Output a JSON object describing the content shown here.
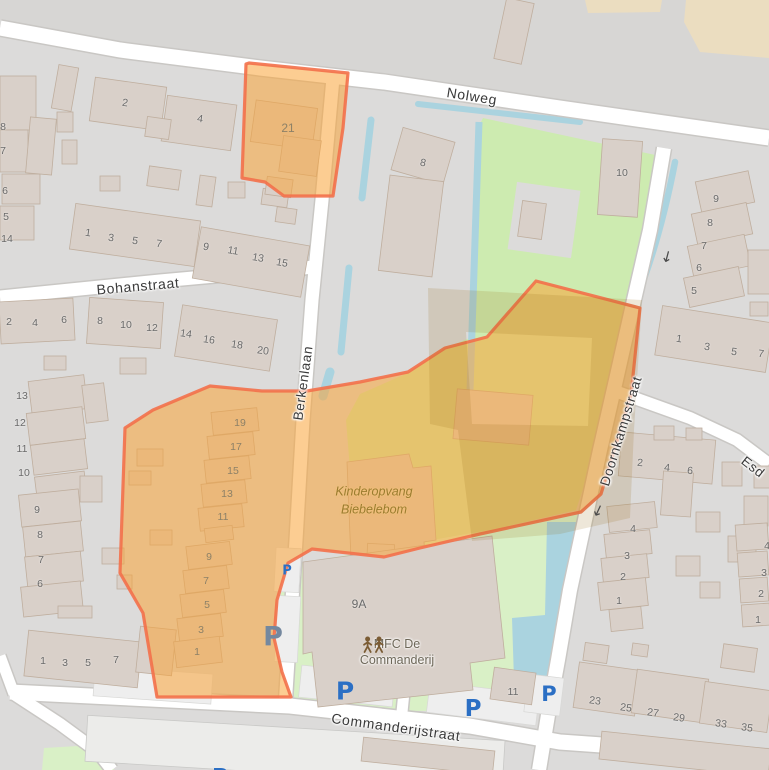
{
  "meta": {
    "width": 769,
    "height": 770,
    "kind": "openstreetmap-view"
  },
  "colors": {
    "bg": "#dcdbda",
    "bg_top": "#d7d6d4",
    "road": "#ffffff",
    "road_casing": "#c9c7c4",
    "building": "#d9d0c9",
    "building_stroke": "#bfae9e",
    "industrial": "#ececea",
    "green": "#cdebb0",
    "green_light": "#d9f0c6",
    "water": "#aad3df",
    "farmland": "#ebddc0",
    "parking_lot": "#eeeeee",
    "sel_fill": "rgba(250,164,56,0.55)",
    "sel_stroke": "#f3704a",
    "shade": "rgba(150,105,20,0.16)",
    "street_text": "#3a3a3a",
    "housenumber": "#6a6a6a",
    "housenumber_dim": "#8d8167",
    "parking_blue": "#2b6fc4",
    "parking_dim": "#74889f",
    "arrow": "#4a4a4a",
    "poi_kdv": "#9a7c2e",
    "poi_mfc": "#6d6758",
    "poi_icon": "#7b5c34"
  },
  "streets": [
    {
      "text": "Nolweg",
      "x": 472,
      "y": 96,
      "rot": 9,
      "size": 14
    },
    {
      "text": "Bohanstraat",
      "x": 138,
      "y": 286,
      "rot": -5,
      "size": 14
    },
    {
      "text": "Berkenlaan",
      "x": 303,
      "y": 383,
      "rot": -82,
      "size": 13.5
    },
    {
      "text": "Doornkampstraat",
      "x": 621,
      "y": 431,
      "rot": -73,
      "size": 13.5
    },
    {
      "text": "Commanderijstraat",
      "x": 396,
      "y": 727,
      "rot": 8,
      "size": 14
    },
    {
      "text": "Esd",
      "x": 753,
      "y": 467,
      "rot": 38,
      "size": 13.5
    }
  ],
  "pois": {
    "kinderopvang": {
      "line1": "Kinderopvang",
      "line2": "Biebelebom",
      "x": 374,
      "y": 501
    },
    "mfc": {
      "line1": "MFC De",
      "line2": "Commanderij",
      "x": 397,
      "y": 652,
      "icon": "community-centre-icon"
    }
  },
  "parking_label": "P",
  "oneway_glyph": "↓",
  "house_numbers": [
    {
      "t": "2",
      "x": 125,
      "y": 103,
      "r": 8
    },
    {
      "t": "4",
      "x": 200,
      "y": 119,
      "r": 8
    },
    {
      "t": "8",
      "x": 3,
      "y": 127
    },
    {
      "t": "7",
      "x": 3,
      "y": 151
    },
    {
      "t": "6",
      "x": 5,
      "y": 191
    },
    {
      "t": "5",
      "x": 6,
      "y": 217
    },
    {
      "t": "14",
      "x": 7,
      "y": 239
    },
    {
      "t": "1",
      "x": 88,
      "y": 233,
      "r": 8
    },
    {
      "t": "3",
      "x": 111,
      "y": 238,
      "r": 8
    },
    {
      "t": "5",
      "x": 135,
      "y": 241,
      "r": 8
    },
    {
      "t": "7",
      "x": 159,
      "y": 244,
      "r": 8
    },
    {
      "t": "9",
      "x": 206,
      "y": 247,
      "r": 10
    },
    {
      "t": "11",
      "x": 233,
      "y": 251,
      "r": 10
    },
    {
      "t": "13",
      "x": 258,
      "y": 258,
      "r": 10
    },
    {
      "t": "15",
      "x": 282,
      "y": 263,
      "r": 10
    },
    {
      "t": "2",
      "x": 9,
      "y": 322
    },
    {
      "t": "4",
      "x": 35,
      "y": 323
    },
    {
      "t": "6",
      "x": 64,
      "y": 320
    },
    {
      "t": "8",
      "x": 100,
      "y": 321
    },
    {
      "t": "10",
      "x": 126,
      "y": 325
    },
    {
      "t": "12",
      "x": 152,
      "y": 328
    },
    {
      "t": "14",
      "x": 186,
      "y": 334,
      "r": 8
    },
    {
      "t": "16",
      "x": 209,
      "y": 340,
      "r": 8
    },
    {
      "t": "18",
      "x": 237,
      "y": 345,
      "r": 8
    },
    {
      "t": "20",
      "x": 263,
      "y": 351,
      "r": 8
    },
    {
      "t": "13",
      "x": 22,
      "y": 396
    },
    {
      "t": "12",
      "x": 20,
      "y": 423
    },
    {
      "t": "11",
      "x": 22,
      "y": 449
    },
    {
      "t": "10",
      "x": 24,
      "y": 473
    },
    {
      "t": "9",
      "x": 37,
      "y": 510
    },
    {
      "t": "8",
      "x": 40,
      "y": 535
    },
    {
      "t": "7",
      "x": 41,
      "y": 560
    },
    {
      "t": "6",
      "x": 40,
      "y": 584
    },
    {
      "t": "1",
      "x": 43,
      "y": 661
    },
    {
      "t": "3",
      "x": 65,
      "y": 663
    },
    {
      "t": "5",
      "x": 88,
      "y": 663
    },
    {
      "t": "7",
      "x": 116,
      "y": 660
    },
    {
      "t": "19",
      "x": 240,
      "y": 423,
      "d": 1
    },
    {
      "t": "17",
      "x": 236,
      "y": 447,
      "d": 1
    },
    {
      "t": "15",
      "x": 233,
      "y": 471,
      "d": 1
    },
    {
      "t": "13",
      "x": 227,
      "y": 494,
      "d": 1
    },
    {
      "t": "11",
      "x": 223,
      "y": 517,
      "d": 1
    },
    {
      "t": "9",
      "x": 209,
      "y": 557,
      "d": 1
    },
    {
      "t": "7",
      "x": 206,
      "y": 581,
      "d": 1
    },
    {
      "t": "5",
      "x": 207,
      "y": 605,
      "d": 1
    },
    {
      "t": "3",
      "x": 201,
      "y": 630,
      "d": 1
    },
    {
      "t": "1",
      "x": 197,
      "y": 652,
      "d": 1
    },
    {
      "t": "21",
      "x": 288,
      "y": 128,
      "d": 1,
      "s": 12
    },
    {
      "t": "8",
      "x": 423,
      "y": 163,
      "r": 12
    },
    {
      "t": "10",
      "x": 622,
      "y": 173
    },
    {
      "t": "9",
      "x": 716,
      "y": 199
    },
    {
      "t": "8",
      "x": 710,
      "y": 223
    },
    {
      "t": "7",
      "x": 704,
      "y": 246
    },
    {
      "t": "6",
      "x": 699,
      "y": 268
    },
    {
      "t": "5",
      "x": 694,
      "y": 291
    },
    {
      "t": "1",
      "x": 679,
      "y": 339,
      "r": 8
    },
    {
      "t": "3",
      "x": 707,
      "y": 347,
      "r": 8
    },
    {
      "t": "5",
      "x": 734,
      "y": 352,
      "r": 8
    },
    {
      "t": "7",
      "x": 761,
      "y": 354,
      "r": 8
    },
    {
      "t": "2",
      "x": 640,
      "y": 463,
      "r": 5
    },
    {
      "t": "4",
      "x": 667,
      "y": 468,
      "r": 5
    },
    {
      "t": "6",
      "x": 690,
      "y": 471,
      "r": 5
    },
    {
      "t": "4",
      "x": 633,
      "y": 529
    },
    {
      "t": "3",
      "x": 627,
      "y": 556
    },
    {
      "t": "2",
      "x": 623,
      "y": 577
    },
    {
      "t": "1",
      "x": 619,
      "y": 601
    },
    {
      "t": "4",
      "x": 767,
      "y": 546
    },
    {
      "t": "3",
      "x": 764,
      "y": 573
    },
    {
      "t": "2",
      "x": 761,
      "y": 594
    },
    {
      "t": "1",
      "x": 758,
      "y": 620
    },
    {
      "t": "23",
      "x": 595,
      "y": 701,
      "r": 8
    },
    {
      "t": "25",
      "x": 626,
      "y": 708,
      "r": 8
    },
    {
      "t": "27",
      "x": 653,
      "y": 713,
      "r": 8
    },
    {
      "t": "29",
      "x": 679,
      "y": 718,
      "r": 8
    },
    {
      "t": "33",
      "x": 721,
      "y": 724,
      "r": 8
    },
    {
      "t": "35",
      "x": 747,
      "y": 728,
      "r": 8
    },
    {
      "t": "9A",
      "x": 359,
      "y": 604,
      "s": 12
    },
    {
      "t": "11",
      "x": 513,
      "y": 692
    }
  ],
  "parking": [
    {
      "x": 287,
      "y": 571,
      "size": 13
    },
    {
      "x": 273,
      "y": 637,
      "size": 27,
      "dim": 1
    },
    {
      "x": 345,
      "y": 691,
      "size": 25
    },
    {
      "x": 473,
      "y": 709,
      "size": 23
    },
    {
      "x": 549,
      "y": 694,
      "size": 21
    },
    {
      "x": 220,
      "y": 778,
      "size": 22
    }
  ],
  "oneway_arrows": [
    {
      "x": 667,
      "y": 257,
      "rot": 15
    },
    {
      "x": 598,
      "y": 511,
      "rot": 25
    }
  ]
}
